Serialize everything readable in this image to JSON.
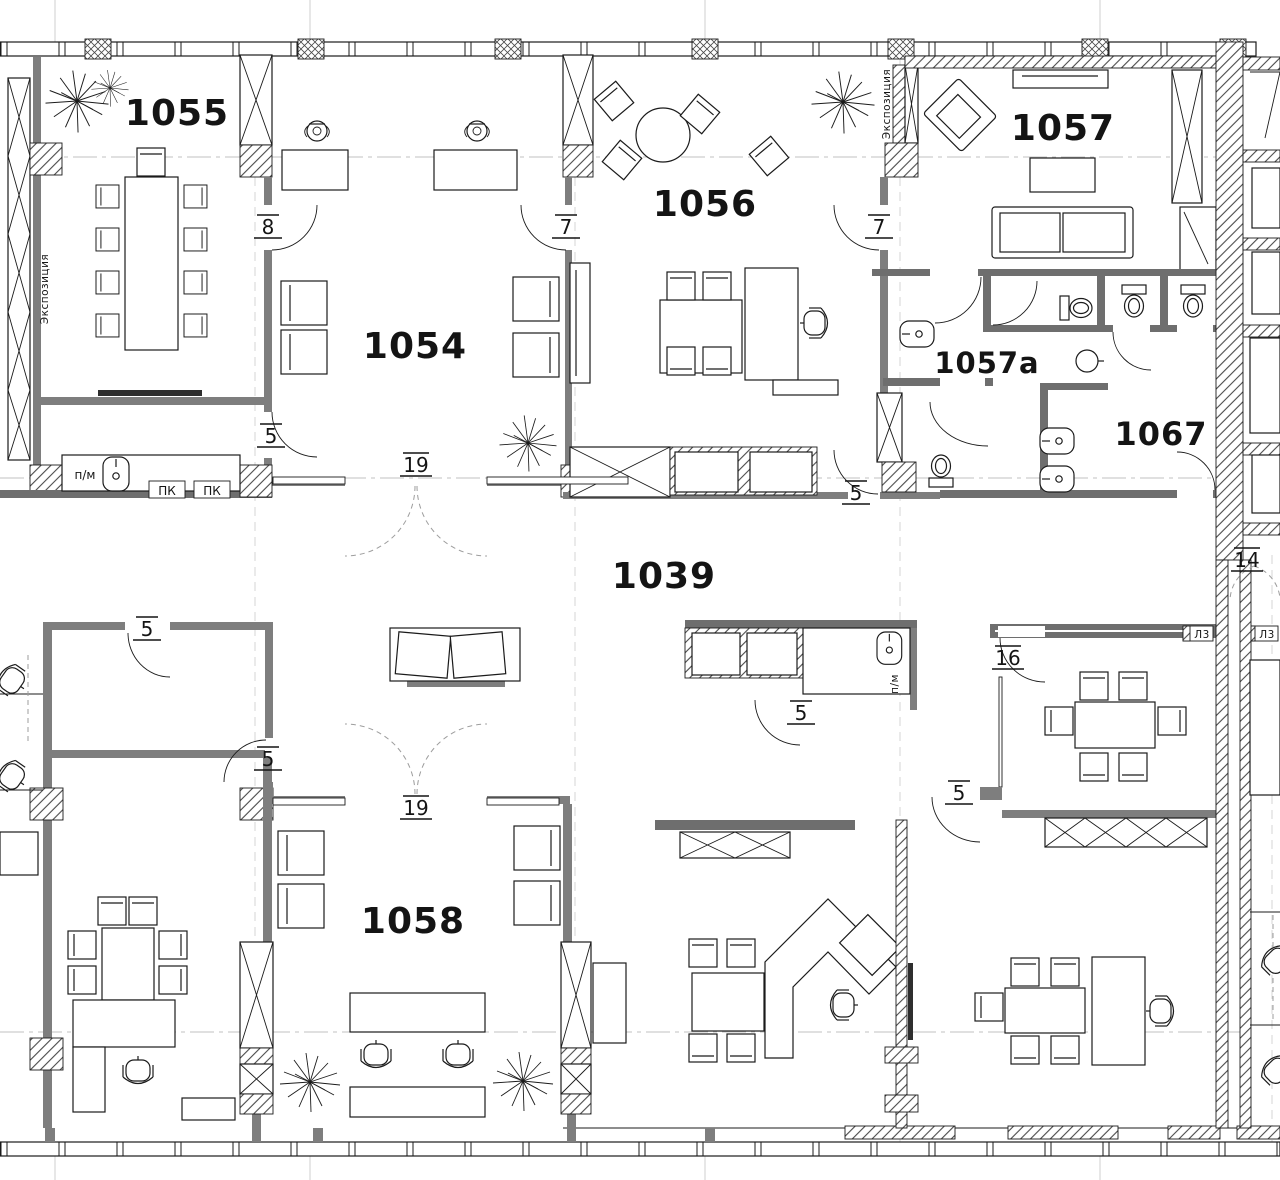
{
  "rooms": {
    "r1055": "1055",
    "r1054": "1054",
    "r1056": "1056",
    "r1057": "1057",
    "r1057a": "1057a",
    "r1067": "1067",
    "r1039": "1039",
    "r1058": "1058"
  },
  "door_tags": {
    "t5": "5",
    "t7": "7",
    "t8": "8",
    "t14": "14",
    "t16": "16",
    "t19": "19"
  },
  "wall_labels": {
    "exposition": "Экспозиция",
    "sink_unit": "п/м",
    "pk_unit": "ПК",
    "lz": "Л3"
  },
  "colors": {
    "background": "#ffffff",
    "line": "#1b1b1b",
    "wall_fill": "#7e7e7e",
    "dark_wall_fill": "#6e6e6e",
    "centerline": "#c2c2c2",
    "hatch": "#4a4a4a"
  }
}
